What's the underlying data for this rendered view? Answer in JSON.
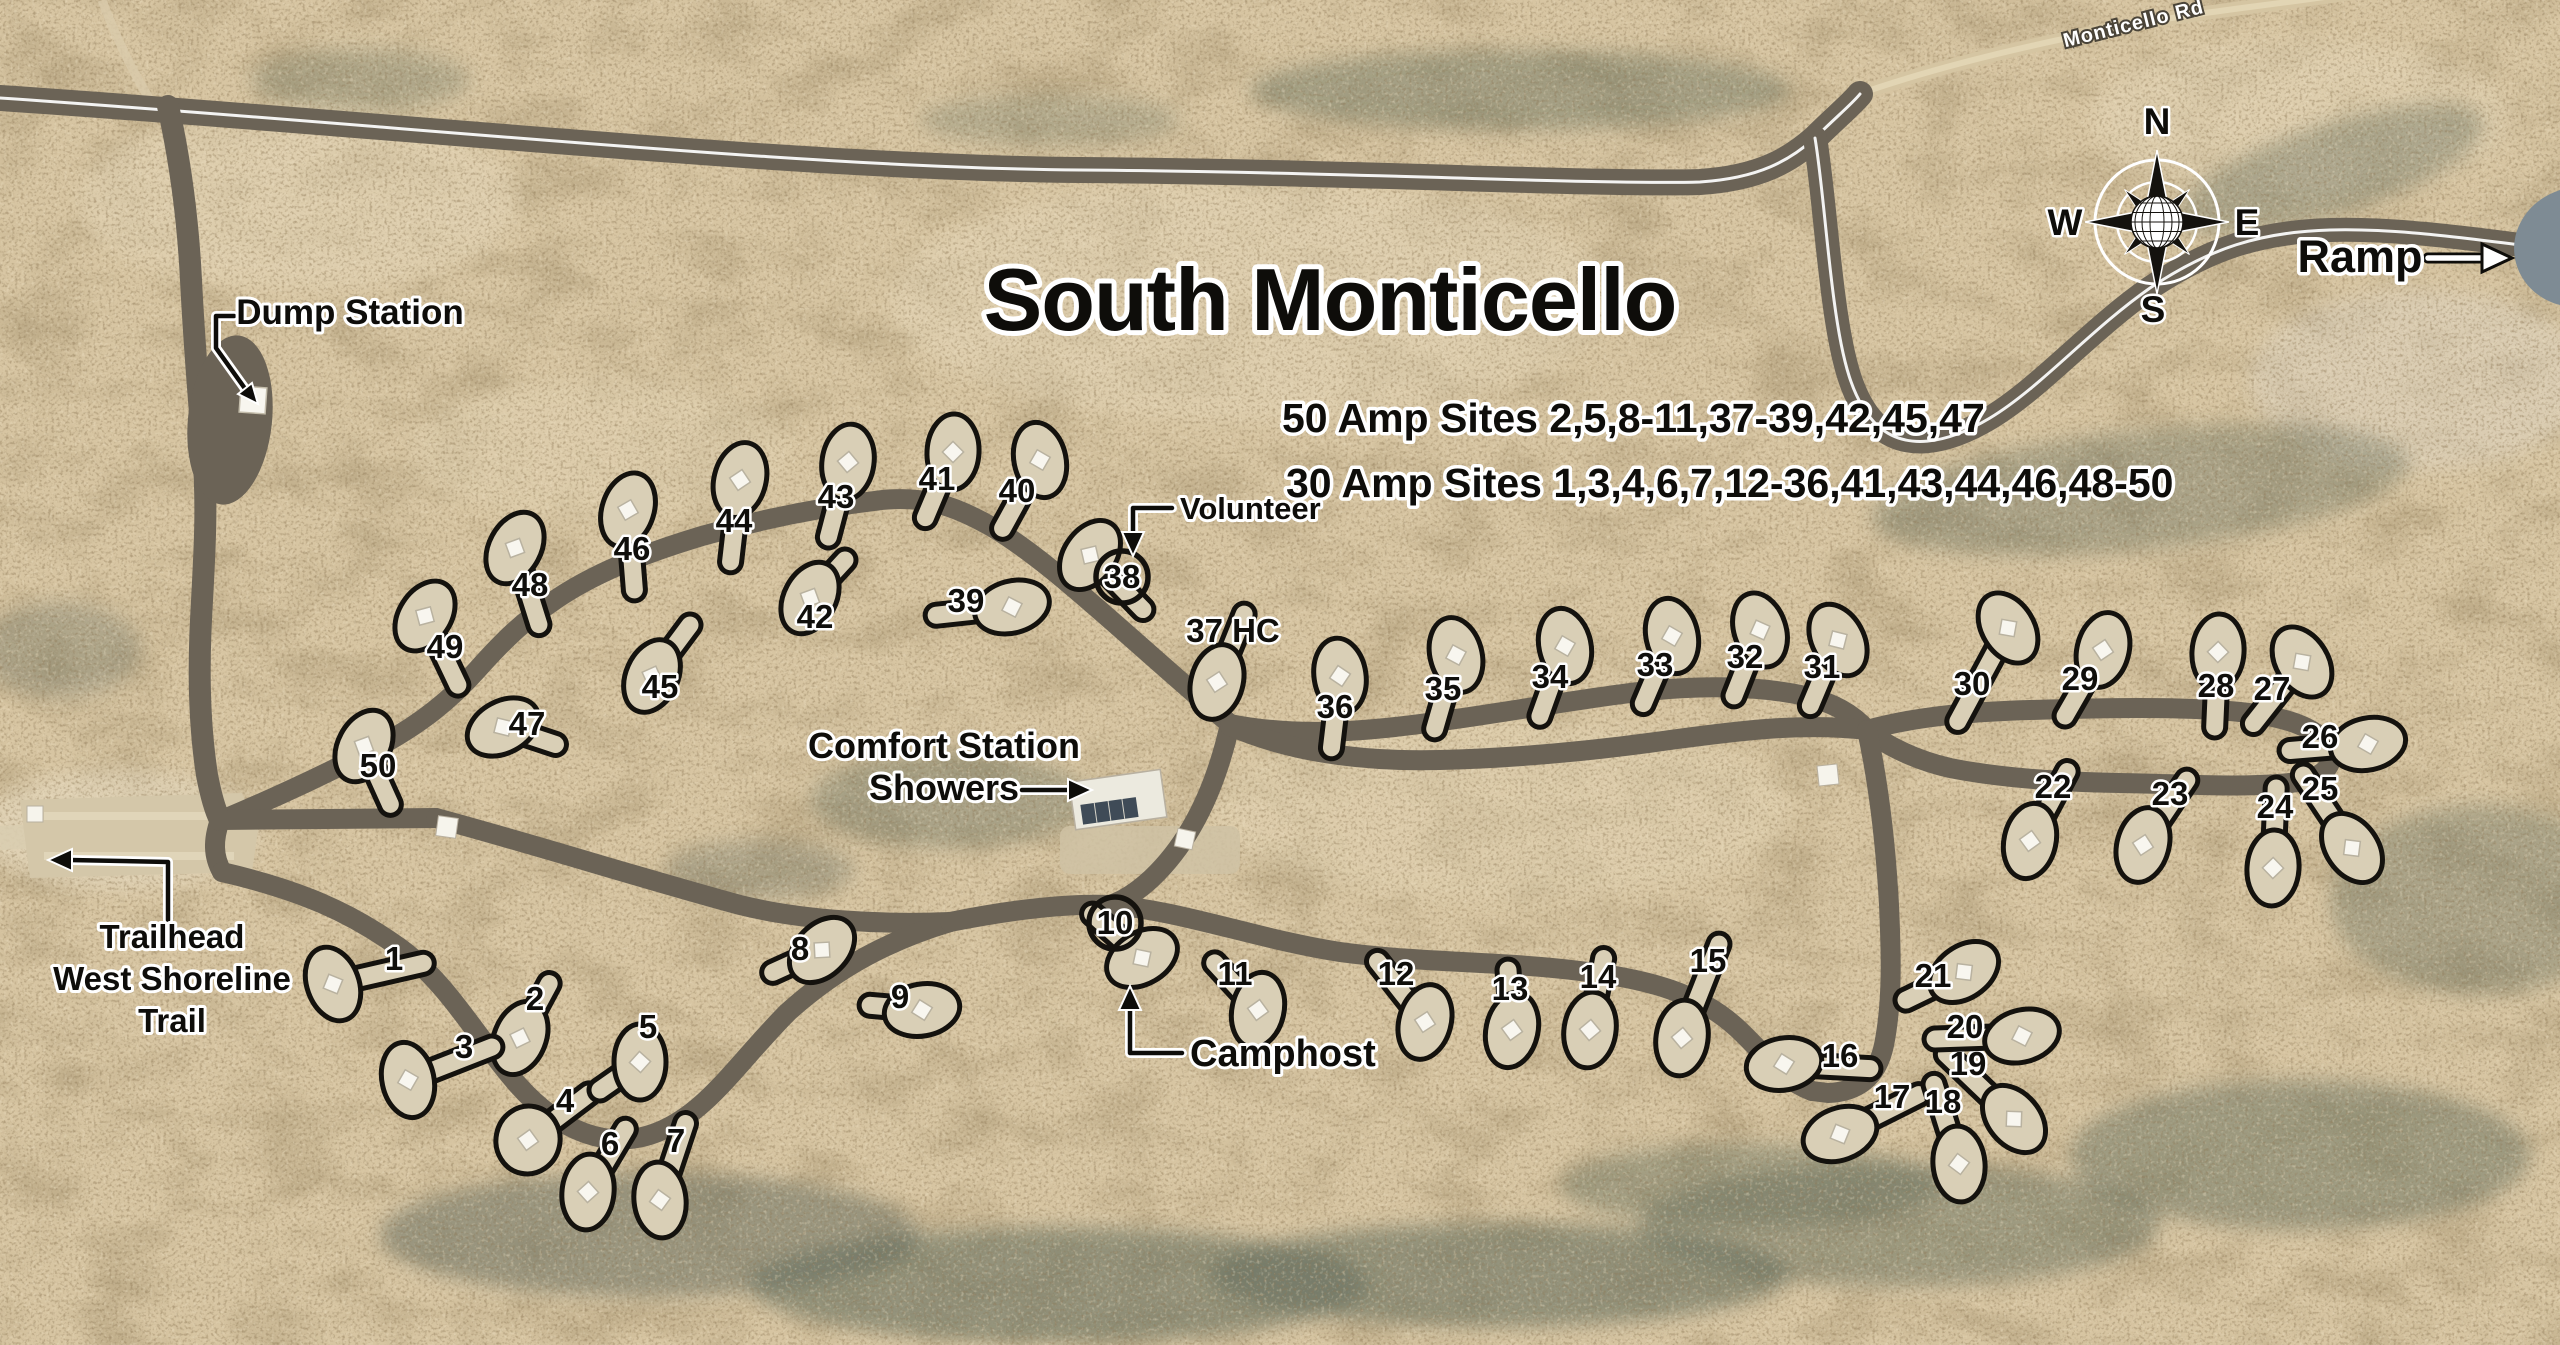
{
  "map": {
    "title": "South Monticello",
    "amp_50": "50 Amp Sites 2,5,8-11,37-39,42,45,47",
    "amp_30": "30 Amp Sites 1,3,4,6,7,12-36,41,43,44,46,48-50",
    "road_name": "Monticello Rd",
    "labels": {
      "dump_station": "Dump Station",
      "trailhead_line1": "Trailhead",
      "trailhead_line2": "West Shoreline",
      "trailhead_line3": "Trail",
      "comfort_line1": "Comfort Station",
      "comfort_line2": "Showers",
      "volunteer": "Volunteer",
      "camphost": "Camphost",
      "ramp": "Ramp"
    },
    "compass": {
      "n": "N",
      "e": "E",
      "s": "S",
      "w": "W"
    },
    "colors": {
      "desert": "#d7c5a2",
      "road": "#6b6356",
      "pad": "#d9cfb6",
      "outline": "#14120e",
      "label_halo": "#ffffff",
      "water": "#7e8b94",
      "vegetation": "#667060"
    },
    "sites": [
      {
        "n": "1",
        "lx": 394,
        "ly": 970,
        "px": 333,
        "py": 984,
        "r": -20
      },
      {
        "n": "2",
        "lx": 535,
        "ly": 1010,
        "px": 520,
        "py": 1038,
        "r": 22
      },
      {
        "n": "3",
        "lx": 464,
        "ly": 1058,
        "px": 408,
        "py": 1080,
        "r": -12
      },
      {
        "n": "4",
        "lx": 565,
        "ly": 1112,
        "px": 528,
        "py": 1140,
        "r": 12,
        "rx": 32,
        "ry": 34
      },
      {
        "n": "5",
        "lx": 648,
        "ly": 1038,
        "px": 640,
        "py": 1062,
        "r": 0,
        "ex": 600,
        "ey": 1090
      },
      {
        "n": "6",
        "lx": 610,
        "ly": 1155,
        "px": 588,
        "py": 1192,
        "r": 6
      },
      {
        "n": "7",
        "lx": 676,
        "ly": 1152,
        "px": 660,
        "py": 1200,
        "r": -6
      },
      {
        "n": "8",
        "lx": 800,
        "ly": 960,
        "px": 822,
        "py": 950,
        "r": 45
      },
      {
        "n": "9",
        "lx": 900,
        "ly": 1008,
        "px": 922,
        "py": 1010,
        "r": 80
      },
      {
        "n": "10",
        "lx": 1115,
        "ly": 934,
        "px": 1142,
        "py": 958,
        "r": 60,
        "c": true
      },
      {
        "n": "11",
        "lx": 1235,
        "ly": 985,
        "px": 1258,
        "py": 1010,
        "r": 12
      },
      {
        "n": "12",
        "lx": 1396,
        "ly": 985,
        "px": 1425,
        "py": 1022,
        "r": 15
      },
      {
        "n": "13",
        "lx": 1510,
        "ly": 1000,
        "px": 1512,
        "py": 1030,
        "r": 12
      },
      {
        "n": "14",
        "lx": 1598,
        "ly": 988,
        "px": 1590,
        "py": 1030,
        "r": 8
      },
      {
        "n": "15",
        "lx": 1708,
        "ly": 972,
        "px": 1682,
        "py": 1038,
        "r": 8
      },
      {
        "n": "16",
        "lx": 1840,
        "ly": 1067,
        "px": 1784,
        "py": 1064,
        "r": 80
      },
      {
        "n": "17",
        "lx": 1892,
        "ly": 1108,
        "px": 1840,
        "py": 1134,
        "r": 70
      },
      {
        "n": "18",
        "lx": 1943,
        "ly": 1113,
        "px": 1959,
        "py": 1164,
        "r": -5
      },
      {
        "n": "19",
        "lx": 1968,
        "ly": 1075,
        "px": 2014,
        "py": 1119,
        "r": -40
      },
      {
        "n": "20",
        "lx": 1965,
        "ly": 1038,
        "px": 2022,
        "py": 1036,
        "r": 75
      },
      {
        "n": "21",
        "lx": 1933,
        "ly": 987,
        "px": 1964,
        "py": 972,
        "r": 55
      },
      {
        "n": "22",
        "lx": 2053,
        "ly": 798,
        "px": 2030,
        "py": 841,
        "r": 12
      },
      {
        "n": "23",
        "lx": 2170,
        "ly": 805,
        "px": 2143,
        "py": 845,
        "r": 15
      },
      {
        "n": "24",
        "lx": 2275,
        "ly": 818,
        "px": 2273,
        "py": 868,
        "r": 4
      },
      {
        "n": "25",
        "lx": 2320,
        "ly": 800,
        "px": 2352,
        "py": 848,
        "r": -35
      },
      {
        "n": "26",
        "lx": 2320,
        "ly": 748,
        "px": 2368,
        "py": 744,
        "r": 78
      },
      {
        "n": "27",
        "lx": 2272,
        "ly": 700,
        "px": 2302,
        "py": 662,
        "r": -32
      },
      {
        "n": "28",
        "lx": 2216,
        "ly": 697,
        "px": 2218,
        "py": 652,
        "r": 4
      },
      {
        "n": "29",
        "lx": 2080,
        "ly": 690,
        "px": 2103,
        "py": 650,
        "r": 14
      },
      {
        "n": "30",
        "lx": 1972,
        "ly": 695,
        "px": 2008,
        "py": 628,
        "r": -32
      },
      {
        "n": "31",
        "lx": 1822,
        "ly": 678,
        "px": 1838,
        "py": 640,
        "r": -28
      },
      {
        "n": "32",
        "lx": 1745,
        "ly": 668,
        "px": 1760,
        "py": 630,
        "r": -18
      },
      {
        "n": "33",
        "lx": 1655,
        "ly": 676,
        "px": 1672,
        "py": 636,
        "r": -12
      },
      {
        "n": "34",
        "lx": 1550,
        "ly": 688,
        "px": 1565,
        "py": 646,
        "r": -12
      },
      {
        "n": "35",
        "lx": 1443,
        "ly": 700,
        "px": 1456,
        "py": 655,
        "r": -14
      },
      {
        "n": "36",
        "lx": 1335,
        "ly": 718,
        "px": 1340,
        "py": 676,
        "r": -8
      },
      {
        "n": "37 HC",
        "lx": 1233,
        "ly": 642,
        "px": 1217,
        "py": 682,
        "r": 15
      },
      {
        "n": "38",
        "lx": 1122,
        "ly": 588,
        "px": 1090,
        "py": 555,
        "r": 35,
        "c": true
      },
      {
        "n": "39",
        "lx": 966,
        "ly": 612,
        "px": 1012,
        "py": 607,
        "r": 75
      },
      {
        "n": "40",
        "lx": 1017,
        "ly": 502,
        "px": 1040,
        "py": 460,
        "r": -12
      },
      {
        "n": "41",
        "lx": 937,
        "ly": 490,
        "px": 953,
        "py": 452,
        "r": 3
      },
      {
        "n": "42",
        "lx": 815,
        "ly": 628,
        "px": 810,
        "py": 598,
        "r": 28,
        "ex": 845,
        "ey": 560
      },
      {
        "n": "43",
        "lx": 836,
        "ly": 508,
        "px": 848,
        "py": 462,
        "r": 8
      },
      {
        "n": "44",
        "lx": 734,
        "ly": 532,
        "px": 740,
        "py": 480,
        "r": 14
      },
      {
        "n": "45",
        "lx": 660,
        "ly": 698,
        "px": 652,
        "py": 676,
        "r": 24,
        "ex": 690,
        "ey": 625
      },
      {
        "n": "46",
        "lx": 632,
        "ly": 560,
        "px": 628,
        "py": 510,
        "r": 18
      },
      {
        "n": "47",
        "lx": 527,
        "ly": 735,
        "px": 503,
        "py": 727,
        "r": 62
      },
      {
        "n": "48",
        "lx": 530,
        "ly": 596,
        "px": 515,
        "py": 548,
        "r": 28
      },
      {
        "n": "49",
        "lx": 445,
        "ly": 658,
        "px": 425,
        "py": 616,
        "r": 33
      },
      {
        "n": "50",
        "lx": 378,
        "ly": 777,
        "px": 364,
        "py": 746,
        "r": 28
      }
    ]
  }
}
